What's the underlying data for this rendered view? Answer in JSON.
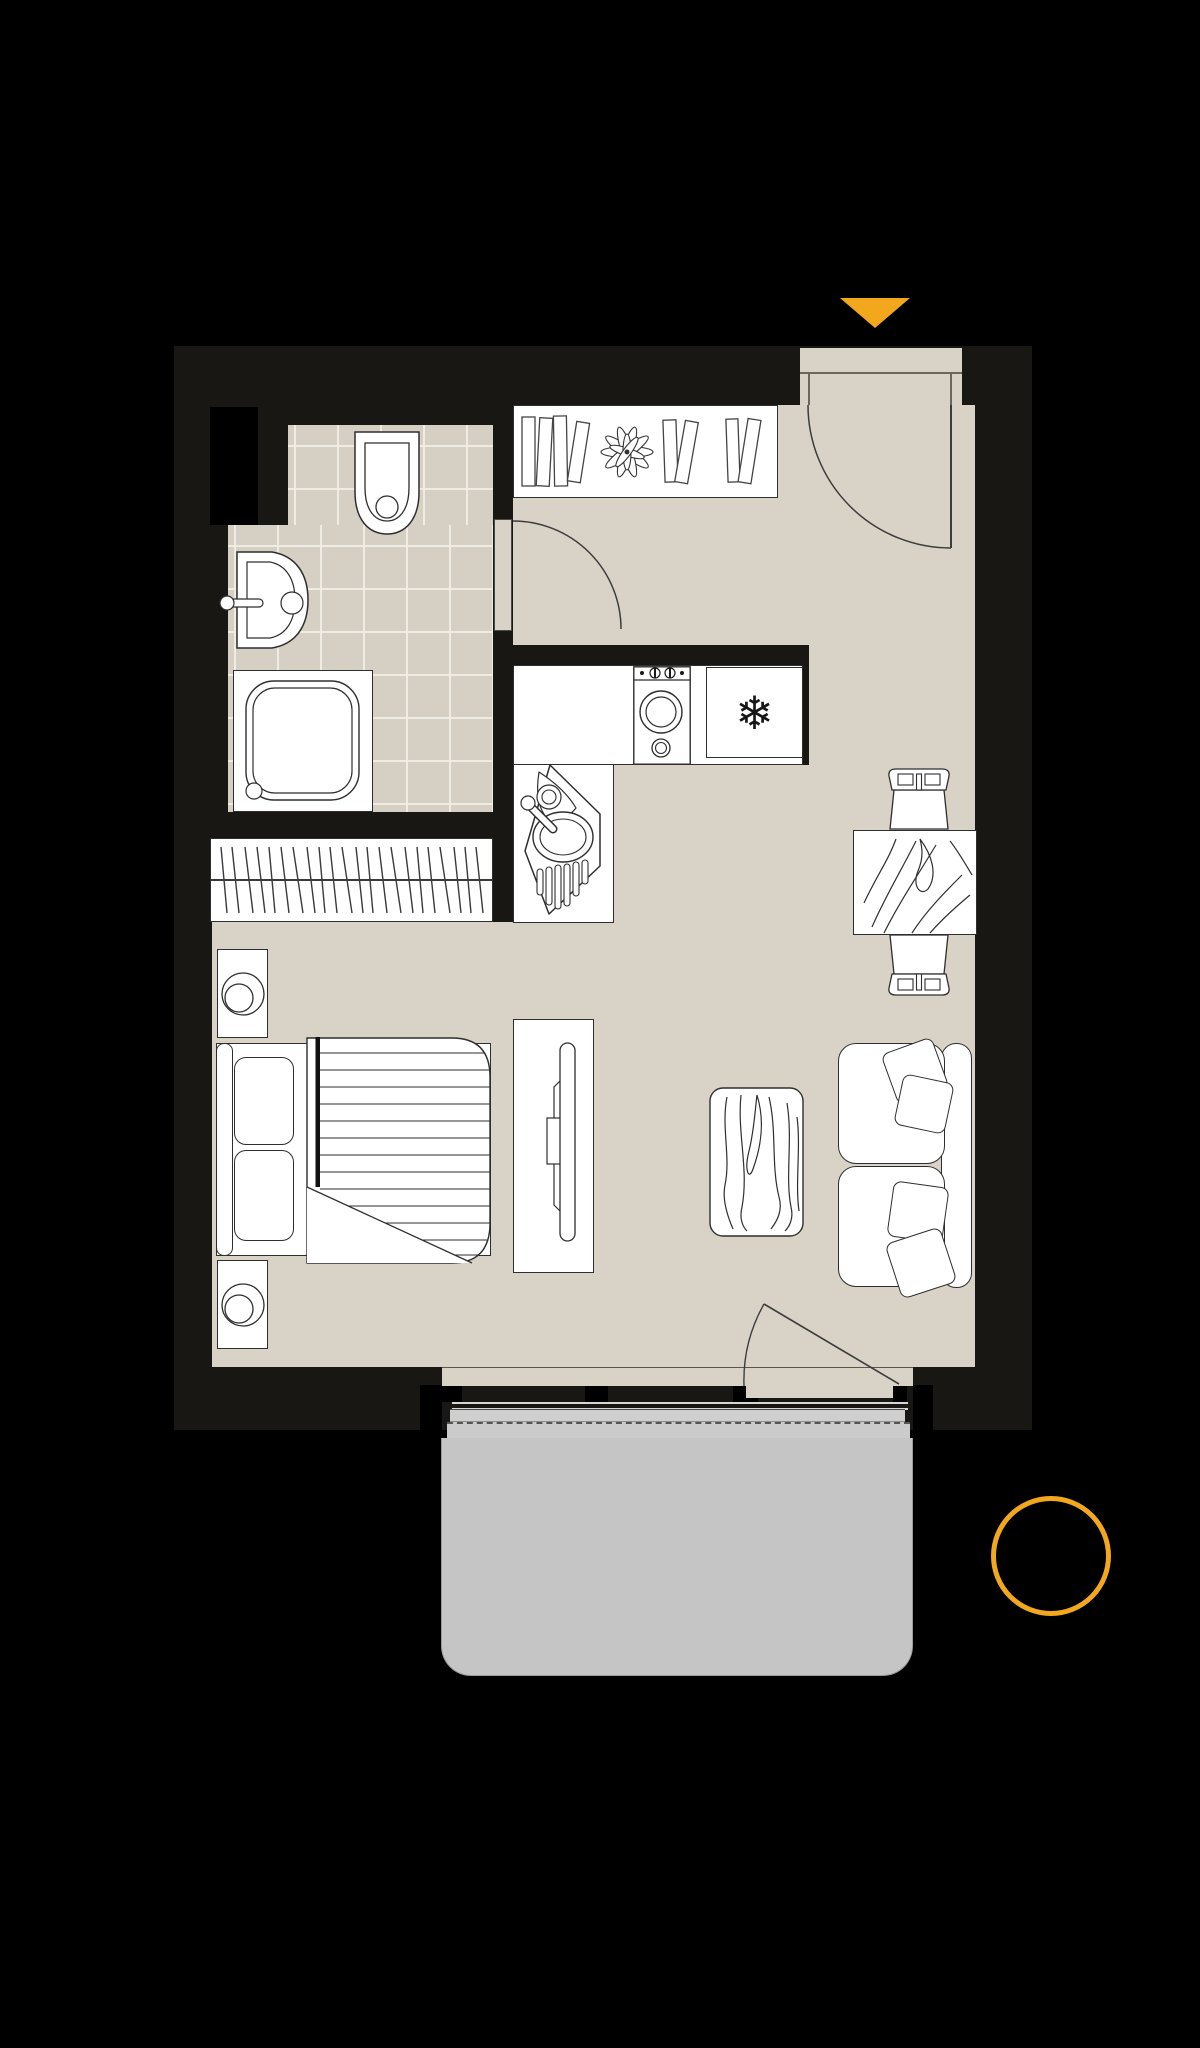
{
  "plan": {
    "title": "studio-apartment-floor-plan",
    "colors": {
      "bg": "#000000",
      "wall": "#181714",
      "floor": "#d9d3c7",
      "tile": "#d6d0c4",
      "grout": "#efece4",
      "outline": "#2e2e2e",
      "accent": "#f3a71d",
      "balcony_slab": "#c5c5c5",
      "balcony_band": "#cfcfcf",
      "glass": "#d8d6d0",
      "fixture": "#ffffff",
      "doorline": "#3c3c3c"
    },
    "markers": {
      "entrance_arrow": "triangle-down",
      "highlight_circle": "circle-outline"
    },
    "kitchen": {
      "fridge_symbol": "❄"
    },
    "rooms": [
      "bathroom",
      "hall",
      "kitchen",
      "living-sleeping-area",
      "balcony"
    ],
    "furniture": [
      "toilet",
      "washbasin",
      "shower",
      "wardrobe",
      "bookshelf",
      "plant",
      "washing-machine",
      "refrigerator",
      "kitchen-sink",
      "dining-table",
      "dining-chairs",
      "bed",
      "nightstands",
      "table-lamps",
      "tv-console",
      "tv",
      "rug",
      "sofa",
      "throw-pillows"
    ]
  }
}
